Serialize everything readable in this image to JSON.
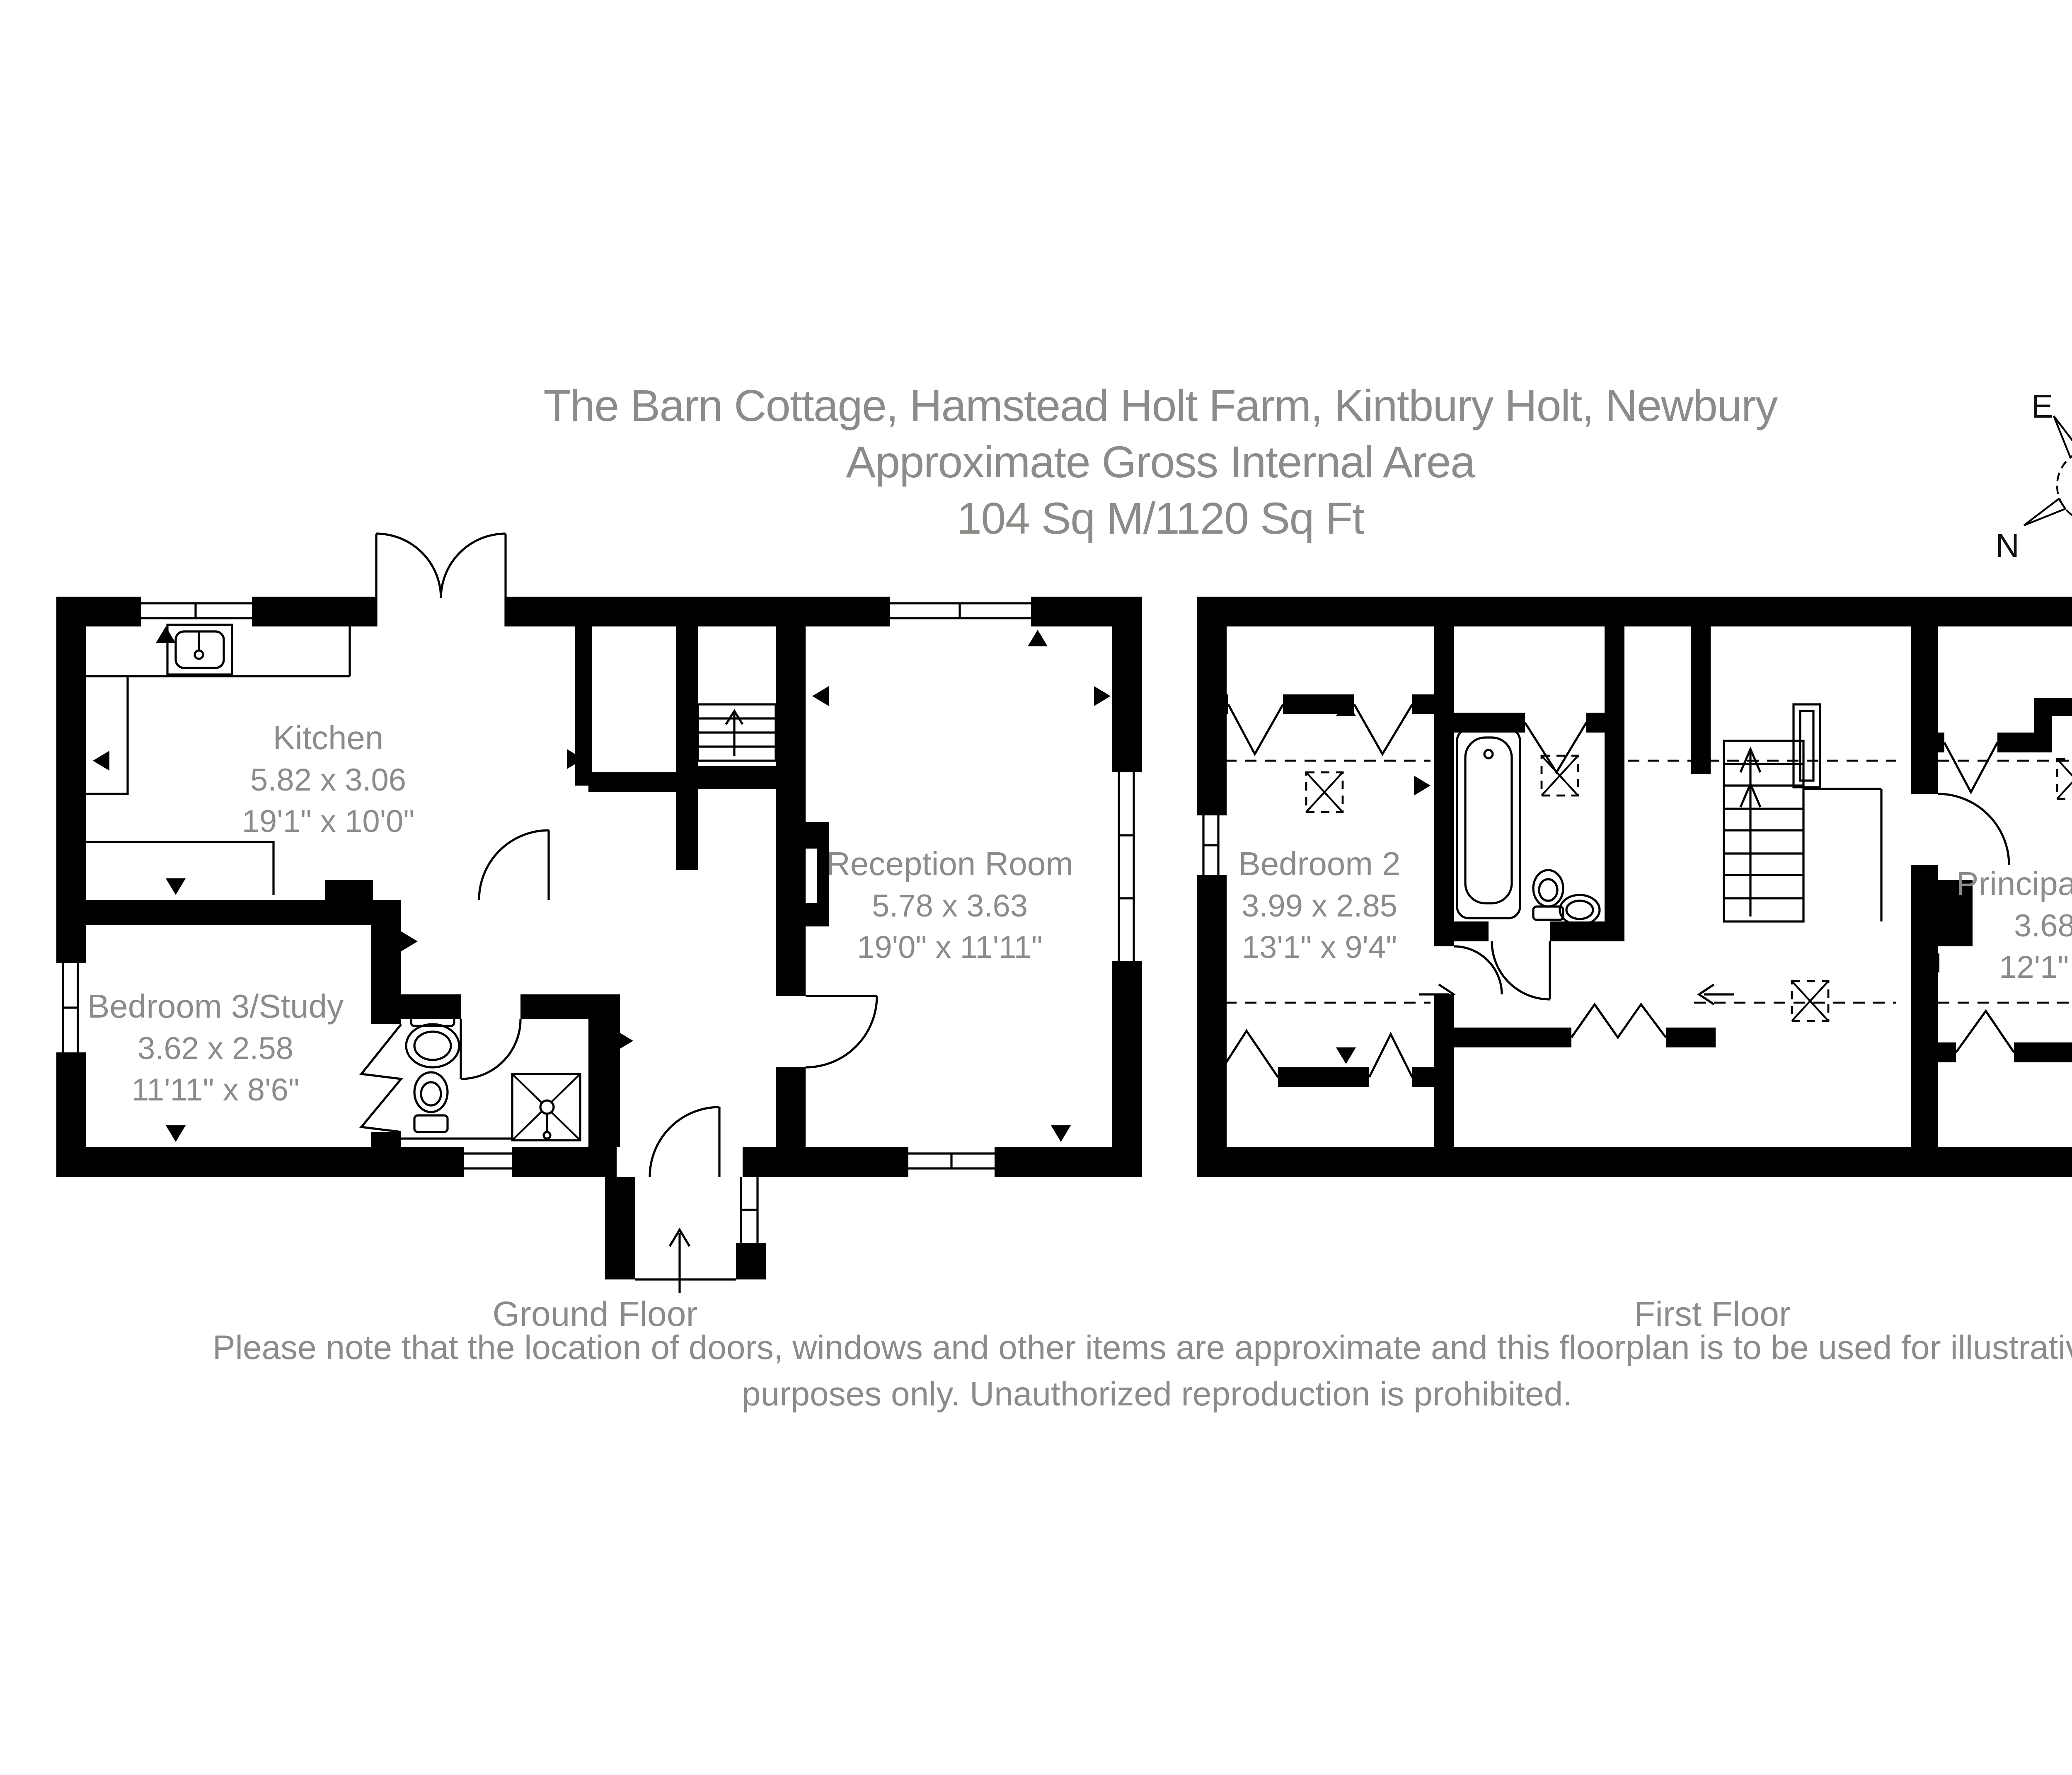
{
  "title": {
    "line1": "The Barn Cottage, Hamstead Holt Farm, Kintbury Holt, Newbury",
    "line2": "Approximate Gross Internal Area",
    "line3": "104 Sq M/1120 Sq Ft"
  },
  "compass": {
    "north": "N",
    "east": "E",
    "south": "S",
    "west": "W"
  },
  "ground_floor": {
    "caption": "Ground Floor",
    "rooms": [
      {
        "name": "Kitchen",
        "metric": "5.82 x 3.06",
        "imperial": "19'1\" x 10'0\""
      },
      {
        "name": "Reception Room",
        "metric": "5.78 x 3.63",
        "imperial": "19'0\" x 11'11\""
      },
      {
        "name": "Bedroom 3/Study",
        "metric": "3.62 x 2.58",
        "imperial": "11'11\" x 8'6\""
      }
    ]
  },
  "first_floor": {
    "caption": "First Floor",
    "rooms": [
      {
        "name": "Bedroom 2",
        "metric": "3.99 x 2.85",
        "imperial": "13'1\" x 9'4\""
      },
      {
        "name": "Principal Bedroom",
        "metric": "3.68 x 3.63",
        "imperial": "12'1\" x 11'11\""
      }
    ]
  },
  "disclaimer": {
    "line1": "Please note that the location of doors, windows and other items are approximate and this floorplan is to be used for illustrative",
    "line2": "purposes only. Unauthorized reproduction is prohibited."
  },
  "colors": {
    "wall": "#000000",
    "text_gray": "#8b8b88"
  }
}
